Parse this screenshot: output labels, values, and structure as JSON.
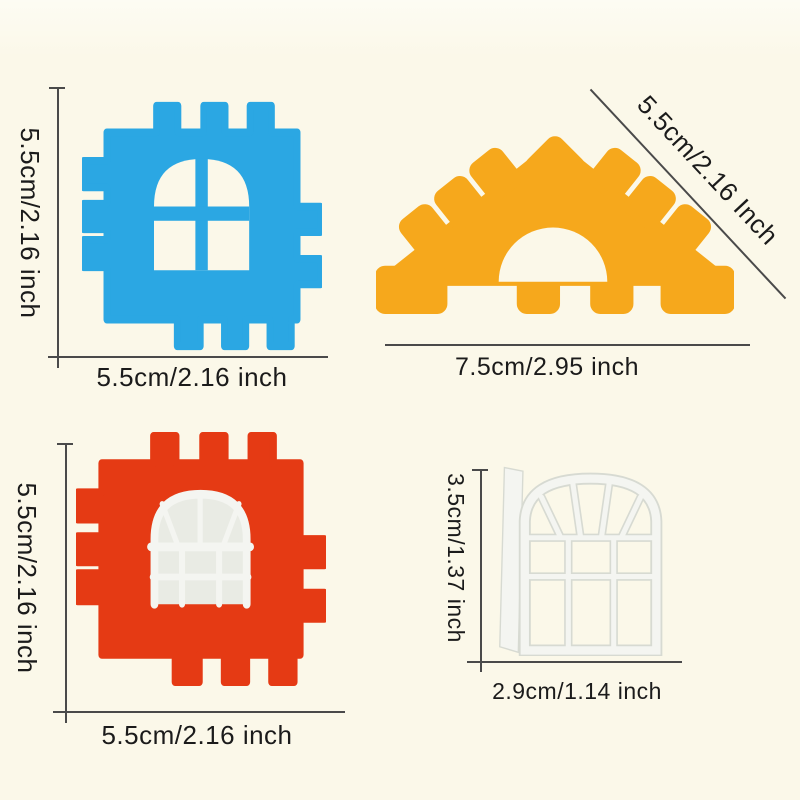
{
  "colors": {
    "background": "#fbf8e9",
    "text": "#1b1b1b",
    "line": "#4a4a4a",
    "blue": "#2ba7e3",
    "orange": "#f6a81c",
    "red": "#e53a14",
    "white_plastic": "#f4f5f1",
    "white_shadow": "#d7dad2",
    "pane": "#e9ebe4"
  },
  "blocks": {
    "blue": {
      "label_height": "5.5cm/2.16 inch",
      "label_width": "5.5cm/2.16 inch"
    },
    "triangle": {
      "label_slope": "5.5cm/2.16 Inch",
      "label_width": "7.5cm/2.95 inch"
    },
    "red": {
      "label_height": "5.5cm/2.16 inch",
      "label_width": "5.5cm/2.16 inch"
    },
    "window": {
      "label_height": "3.5cm/1.37 inch",
      "label_width": "2.9cm/1.14 inch"
    }
  }
}
